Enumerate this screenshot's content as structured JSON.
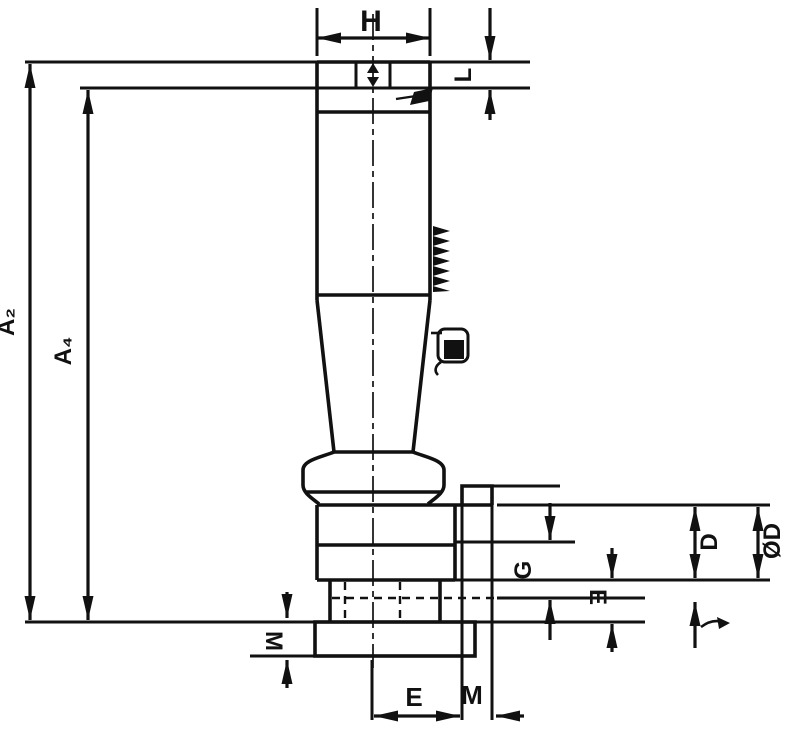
{
  "drawing": {
    "type": "technical-dimension-drawing",
    "background_color": "#ffffff",
    "line_color": "#111111",
    "labels": {
      "top_width": "H",
      "top_right_length": "L",
      "overall_length_outer": "A₂",
      "overall_length_inner": "A₄",
      "groove_length": "G",
      "body_diameter": "D",
      "outer_diameter": "ØD",
      "neck_height": "E",
      "flange_thickness": "M",
      "bottom_width": "E",
      "lug_width": "M"
    }
  }
}
